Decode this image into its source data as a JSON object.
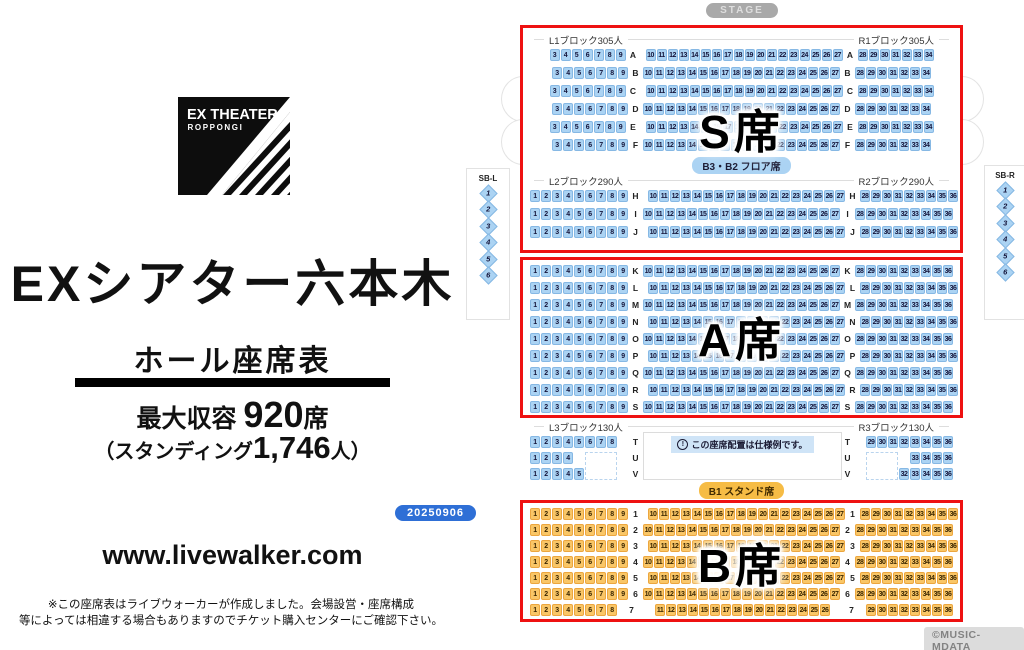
{
  "colors": {
    "seat_blue": "#abd3f3",
    "seat_blue_border": "#86b8e4",
    "seat_orange": "#f9c667",
    "seat_orange_border": "#eca63e",
    "red_border": "#ee1111",
    "stage_bg": "#a9a9a9",
    "pill_blue": "#abd3f3",
    "pill_orange": "#f6bc45",
    "date_pill": "#2e6fd6"
  },
  "left_panel": {
    "logo_line1": "EX THEATER",
    "logo_line2": "ROPPONGI",
    "title": "EXシアター六本木",
    "subtitle": "ホール座席表",
    "capacity_prefix": "最大収容 ",
    "capacity_value": "920",
    "capacity_suffix": "席",
    "standing_prefix": "（スタンディング",
    "standing_value": "1,746",
    "standing_suffix": "人）",
    "date_badge": "20250906",
    "website": "www.livewalker.com",
    "disclaimer_line1": "※この座席表はライブウォーカーが作成しました。会場設営・座席構成",
    "disclaimer_line2": "等によっては相違する場合もありますのでチケット購入センターにご確認下さい。"
  },
  "chart": {
    "stage_label": "STAGE",
    "credit": "©MUSIC-MDATA",
    "notice_text": "この座席配置は仕様例です。",
    "stand_pill": "B1 スタンド席",
    "sb_left": {
      "label": "SB-L",
      "seats": [
        "1",
        "2",
        "3",
        "4",
        "5",
        "6"
      ]
    },
    "sb_right": {
      "label": "SB-R",
      "seats": [
        "1",
        "2",
        "3",
        "4",
        "5",
        "6"
      ]
    },
    "section_s": {
      "big_label": "S席",
      "color": "blue",
      "groups": [
        {
          "left_header": "L1ブロック305人",
          "right_header": "R1ブロック305人",
          "rows": [
            {
              "label": "A",
              "left": [
                3,
                9
              ],
              "center": [
                10,
                27
              ],
              "right": [
                28,
                34
              ],
              "stagger": true
            },
            {
              "label": "B",
              "left": [
                3,
                9
              ],
              "center": [
                10,
                27
              ],
              "right": [
                28,
                34
              ],
              "stagger": false
            },
            {
              "label": "C",
              "left": [
                3,
                9
              ],
              "center": [
                10,
                27
              ],
              "right": [
                28,
                34
              ],
              "stagger": true
            },
            {
              "label": "D",
              "left": [
                3,
                9
              ],
              "center": [
                10,
                27
              ],
              "right": [
                28,
                34
              ],
              "stagger": false
            },
            {
              "label": "E",
              "left": [
                3,
                9
              ],
              "center": [
                10,
                27
              ],
              "right": [
                28,
                34
              ],
              "stagger": true
            },
            {
              "label": "F",
              "left": [
                3,
                9
              ],
              "center": [
                10,
                27
              ],
              "right": [
                28,
                34
              ],
              "stagger": false
            }
          ]
        },
        {
          "pill": "B3・B2 フロア席",
          "left_header": "L2ブロック290人",
          "right_header": "R2ブロック290人",
          "rows": [
            {
              "label": "H",
              "left": [
                1,
                9
              ],
              "center": [
                10,
                27
              ],
              "right": [
                28,
                36
              ],
              "stagger": true
            },
            {
              "label": "I",
              "left": [
                1,
                9
              ],
              "center": [
                10,
                27
              ],
              "right": [
                28,
                36
              ],
              "stagger": false
            },
            {
              "label": "J",
              "left": [
                1,
                9
              ],
              "center": [
                10,
                27
              ],
              "right": [
                28,
                36
              ],
              "stagger": true
            }
          ]
        }
      ]
    },
    "section_a": {
      "big_label": "A席",
      "color": "blue",
      "rows": [
        {
          "label": "K",
          "left": [
            1,
            9
          ],
          "center": [
            10,
            27
          ],
          "right": [
            28,
            36
          ],
          "stagger": false
        },
        {
          "label": "L",
          "left": [
            1,
            9
          ],
          "center": [
            10,
            27
          ],
          "right": [
            28,
            36
          ],
          "stagger": true
        },
        {
          "label": "M",
          "left": [
            1,
            9
          ],
          "center": [
            10,
            27
          ],
          "right": [
            28,
            36
          ],
          "stagger": false
        },
        {
          "label": "N",
          "left": [
            1,
            9
          ],
          "center": [
            10,
            27
          ],
          "right": [
            28,
            36
          ],
          "stagger": true
        },
        {
          "label": "O",
          "left": [
            1,
            9
          ],
          "center": [
            10,
            27
          ],
          "right": [
            28,
            36
          ],
          "stagger": false
        },
        {
          "label": "P",
          "left": [
            1,
            9
          ],
          "center": [
            10,
            27
          ],
          "right": [
            28,
            36
          ],
          "stagger": true
        },
        {
          "label": "Q",
          "left": [
            1,
            9
          ],
          "center": [
            10,
            27
          ],
          "right": [
            28,
            36
          ],
          "stagger": false
        },
        {
          "label": "R",
          "left": [
            1,
            9
          ],
          "center": [
            10,
            27
          ],
          "right": [
            28,
            36
          ],
          "stagger": true
        },
        {
          "label": "S",
          "left": [
            1,
            9
          ],
          "center": [
            10,
            27
          ],
          "right": [
            28,
            36
          ],
          "stagger": false
        }
      ]
    },
    "section_tuv": {
      "left_header": "L3ブロック130人",
      "right_header": "R3ブロック130人",
      "color": "blue",
      "rows": [
        {
          "label": "T",
          "left": [
            1,
            8
          ],
          "right": [
            29,
            36
          ],
          "stagger": false
        },
        {
          "label": "U",
          "left": [
            1,
            4
          ],
          "right": [
            33,
            36
          ],
          "stagger": false
        },
        {
          "label": "V",
          "left": [
            1,
            5
          ],
          "right": [
            32,
            36
          ],
          "stagger": false
        }
      ]
    },
    "section_b": {
      "big_label": "B席",
      "color": "orange",
      "rows": [
        {
          "label": "1",
          "left": [
            1,
            9
          ],
          "center": [
            10,
            27
          ],
          "right": [
            28,
            36
          ],
          "stagger": true
        },
        {
          "label": "2",
          "left": [
            1,
            9
          ],
          "center": [
            10,
            27
          ],
          "right": [
            28,
            36
          ],
          "stagger": false
        },
        {
          "label": "3",
          "left": [
            1,
            9
          ],
          "center": [
            10,
            27
          ],
          "right": [
            28,
            36
          ],
          "stagger": true
        },
        {
          "label": "4",
          "left": [
            1,
            9
          ],
          "center": [
            10,
            27
          ],
          "right": [
            28,
            36
          ],
          "stagger": false
        },
        {
          "label": "5",
          "left": [
            1,
            9
          ],
          "center": [
            10,
            27
          ],
          "right": [
            28,
            36
          ],
          "stagger": true
        },
        {
          "label": "6",
          "left": [
            1,
            9
          ],
          "center": [
            10,
            27
          ],
          "right": [
            28,
            36
          ],
          "stagger": false
        },
        {
          "label": "7",
          "left": [
            1,
            8
          ],
          "center": [
            11,
            26
          ],
          "right": [
            29,
            36
          ],
          "stagger": true
        }
      ]
    }
  }
}
